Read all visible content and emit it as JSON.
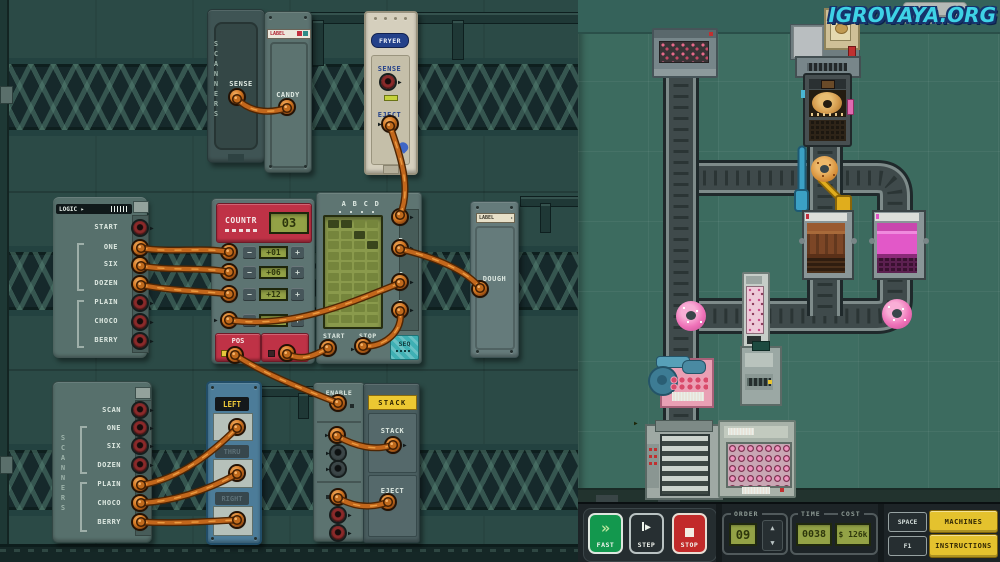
{
  "watermark": "IGROVAYA.ORG",
  "left_panel": {
    "scanner_top": {
      "side_label": "SCANNERS",
      "sense": "SENSE"
    },
    "candy": {
      "strip": "LABEL",
      "label": "CANDY"
    },
    "fryer": {
      "title": "FRYER",
      "sense": "SENSE",
      "eject": "EJECT"
    },
    "logic": {
      "header": "LOGIC ▸",
      "rows": [
        "START",
        "ONE",
        "SIX",
        "DOZEN",
        "PLAIN",
        "CHOCO",
        "BERRY"
      ]
    },
    "counter": {
      "title": "COUNTR",
      "display": "03",
      "increments": [
        "+01",
        "+06",
        "+12",
        ""
      ],
      "pos": "POS"
    },
    "sequencer": {
      "columns": [
        "A",
        "B",
        "C",
        "D"
      ],
      "start": "START",
      "stop": "STOP",
      "badge": "SEQ",
      "grid": {
        "rows": 10,
        "cols": 4,
        "filled": [
          [
            0,
            0
          ],
          [
            0,
            1
          ],
          [
            1,
            2
          ],
          [
            2,
            3
          ]
        ],
        "pointer_row": 1
      }
    },
    "dough": {
      "strip": "LABEL",
      "label": "DOUGH"
    },
    "scanner_bottom": {
      "side_label": "SCANNERS",
      "rows": [
        "SCAN",
        "ONE",
        "SIX",
        "DOZEN",
        "PLAIN",
        "CHOCO",
        "BERRY"
      ]
    },
    "router": {
      "options": [
        "LEFT",
        "THRU",
        "RIGHT"
      ],
      "active": "LEFT"
    },
    "enable": {
      "label": "ENABLE"
    },
    "stack": {
      "badge": "STACK",
      "stack_port": "STACK",
      "eject_port": "EJECT"
    }
  },
  "controls": {
    "fast": "FAST",
    "step": "STEP",
    "stop": "STOP",
    "order_label": "ORDER",
    "order_value": "09",
    "time_label": "TIME",
    "time_value": "0038",
    "cost_label": "COST",
    "cost_value": "$ 126k",
    "space_key": "SPACE",
    "machines": "MACHINES",
    "f1_key": "F1",
    "instructions": "INSTRUCTIONS"
  }
}
